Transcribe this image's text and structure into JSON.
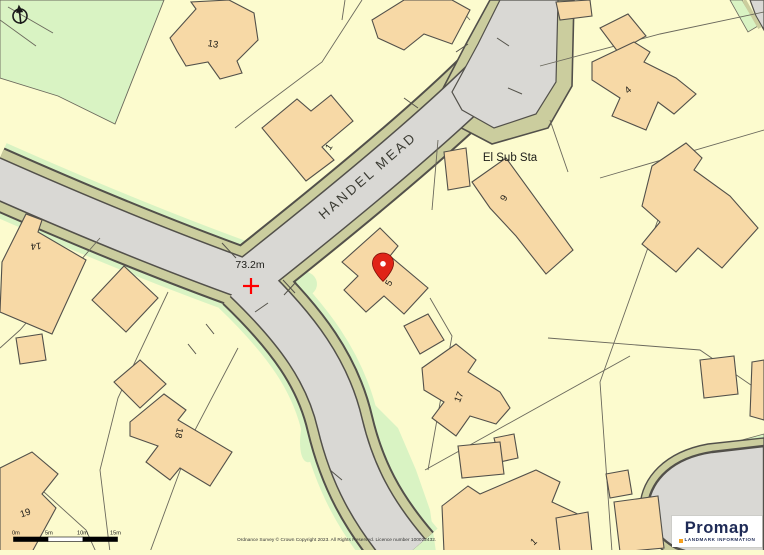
{
  "map": {
    "street_label": "HANDEL MEAD",
    "substation_label": "El Sub Sta",
    "spot_height_label": "73.2m",
    "building_labels": {
      "b13": "13",
      "b1_top": "1",
      "b4": "4",
      "b14": "14",
      "b9": "9",
      "b5": "5",
      "b17": "17",
      "b18": "18",
      "b19": "19",
      "b1_bottom": "1"
    },
    "colors": {
      "background": "#fcfbce",
      "building": "#f7d9a6",
      "road": "#d9d8d4",
      "verge": "#cbcd9e",
      "grass": "#d9f3c3",
      "outline": "#52504a",
      "marker_red": "#e02417",
      "spot_height_red": "#ff0000"
    }
  },
  "scale_bar": {
    "labels": [
      "0m",
      "5m",
      "10m",
      "15m"
    ]
  },
  "footer": {
    "copyright": "Ordnance Survey © Crown Copyright 2023. All Rights Reserved. Licence number 100022432."
  },
  "branding": {
    "name": "Promap",
    "tagline": "LANDMARK INFORMATION",
    "accent": "#f6a01d",
    "text_color": "#1e2a56"
  }
}
